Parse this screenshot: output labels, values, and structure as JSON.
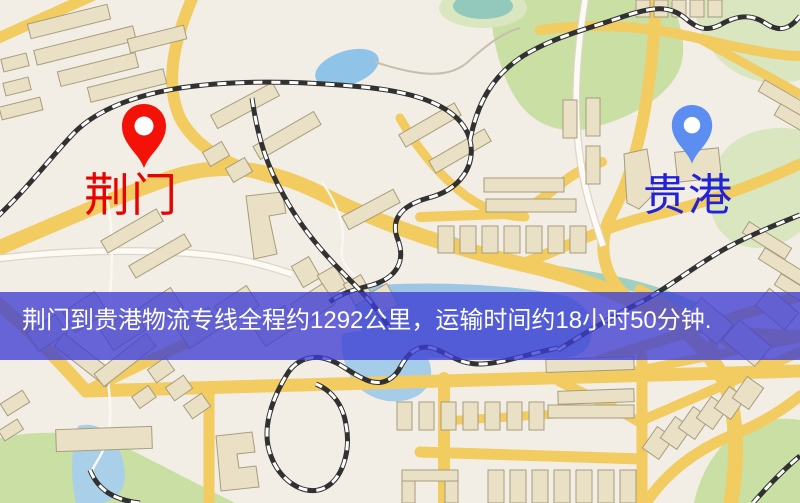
{
  "map": {
    "kind": "road-map-with-route-overlay",
    "markers": [
      {
        "id": "origin",
        "label": "荆门",
        "pin_color": "#f31108",
        "label_color": "#e60300"
      },
      {
        "id": "destination",
        "label": "贵港",
        "pin_color": "#5b8ef0",
        "label_color": "#2222d8"
      }
    ]
  },
  "route_banner": {
    "text": "荆门到贵港物流专线全程约1292公里，运输时间约18小时50分钟.",
    "origin": "荆门",
    "destination": "贵港",
    "distance_km": 1292,
    "duration_hours": 18,
    "duration_minutes": 50,
    "background_color": "#3e3ed4",
    "text_color": "#ffffff"
  },
  "map_palette": {
    "background": "#f3eee5",
    "road_yellow": "#f2cb61",
    "road_white": "#fcfaf4",
    "park_green": "#c9dfa4",
    "water_blue": "#9cc6e4",
    "building_fill": "#e9e0c6",
    "railway_dark": "#313131"
  }
}
